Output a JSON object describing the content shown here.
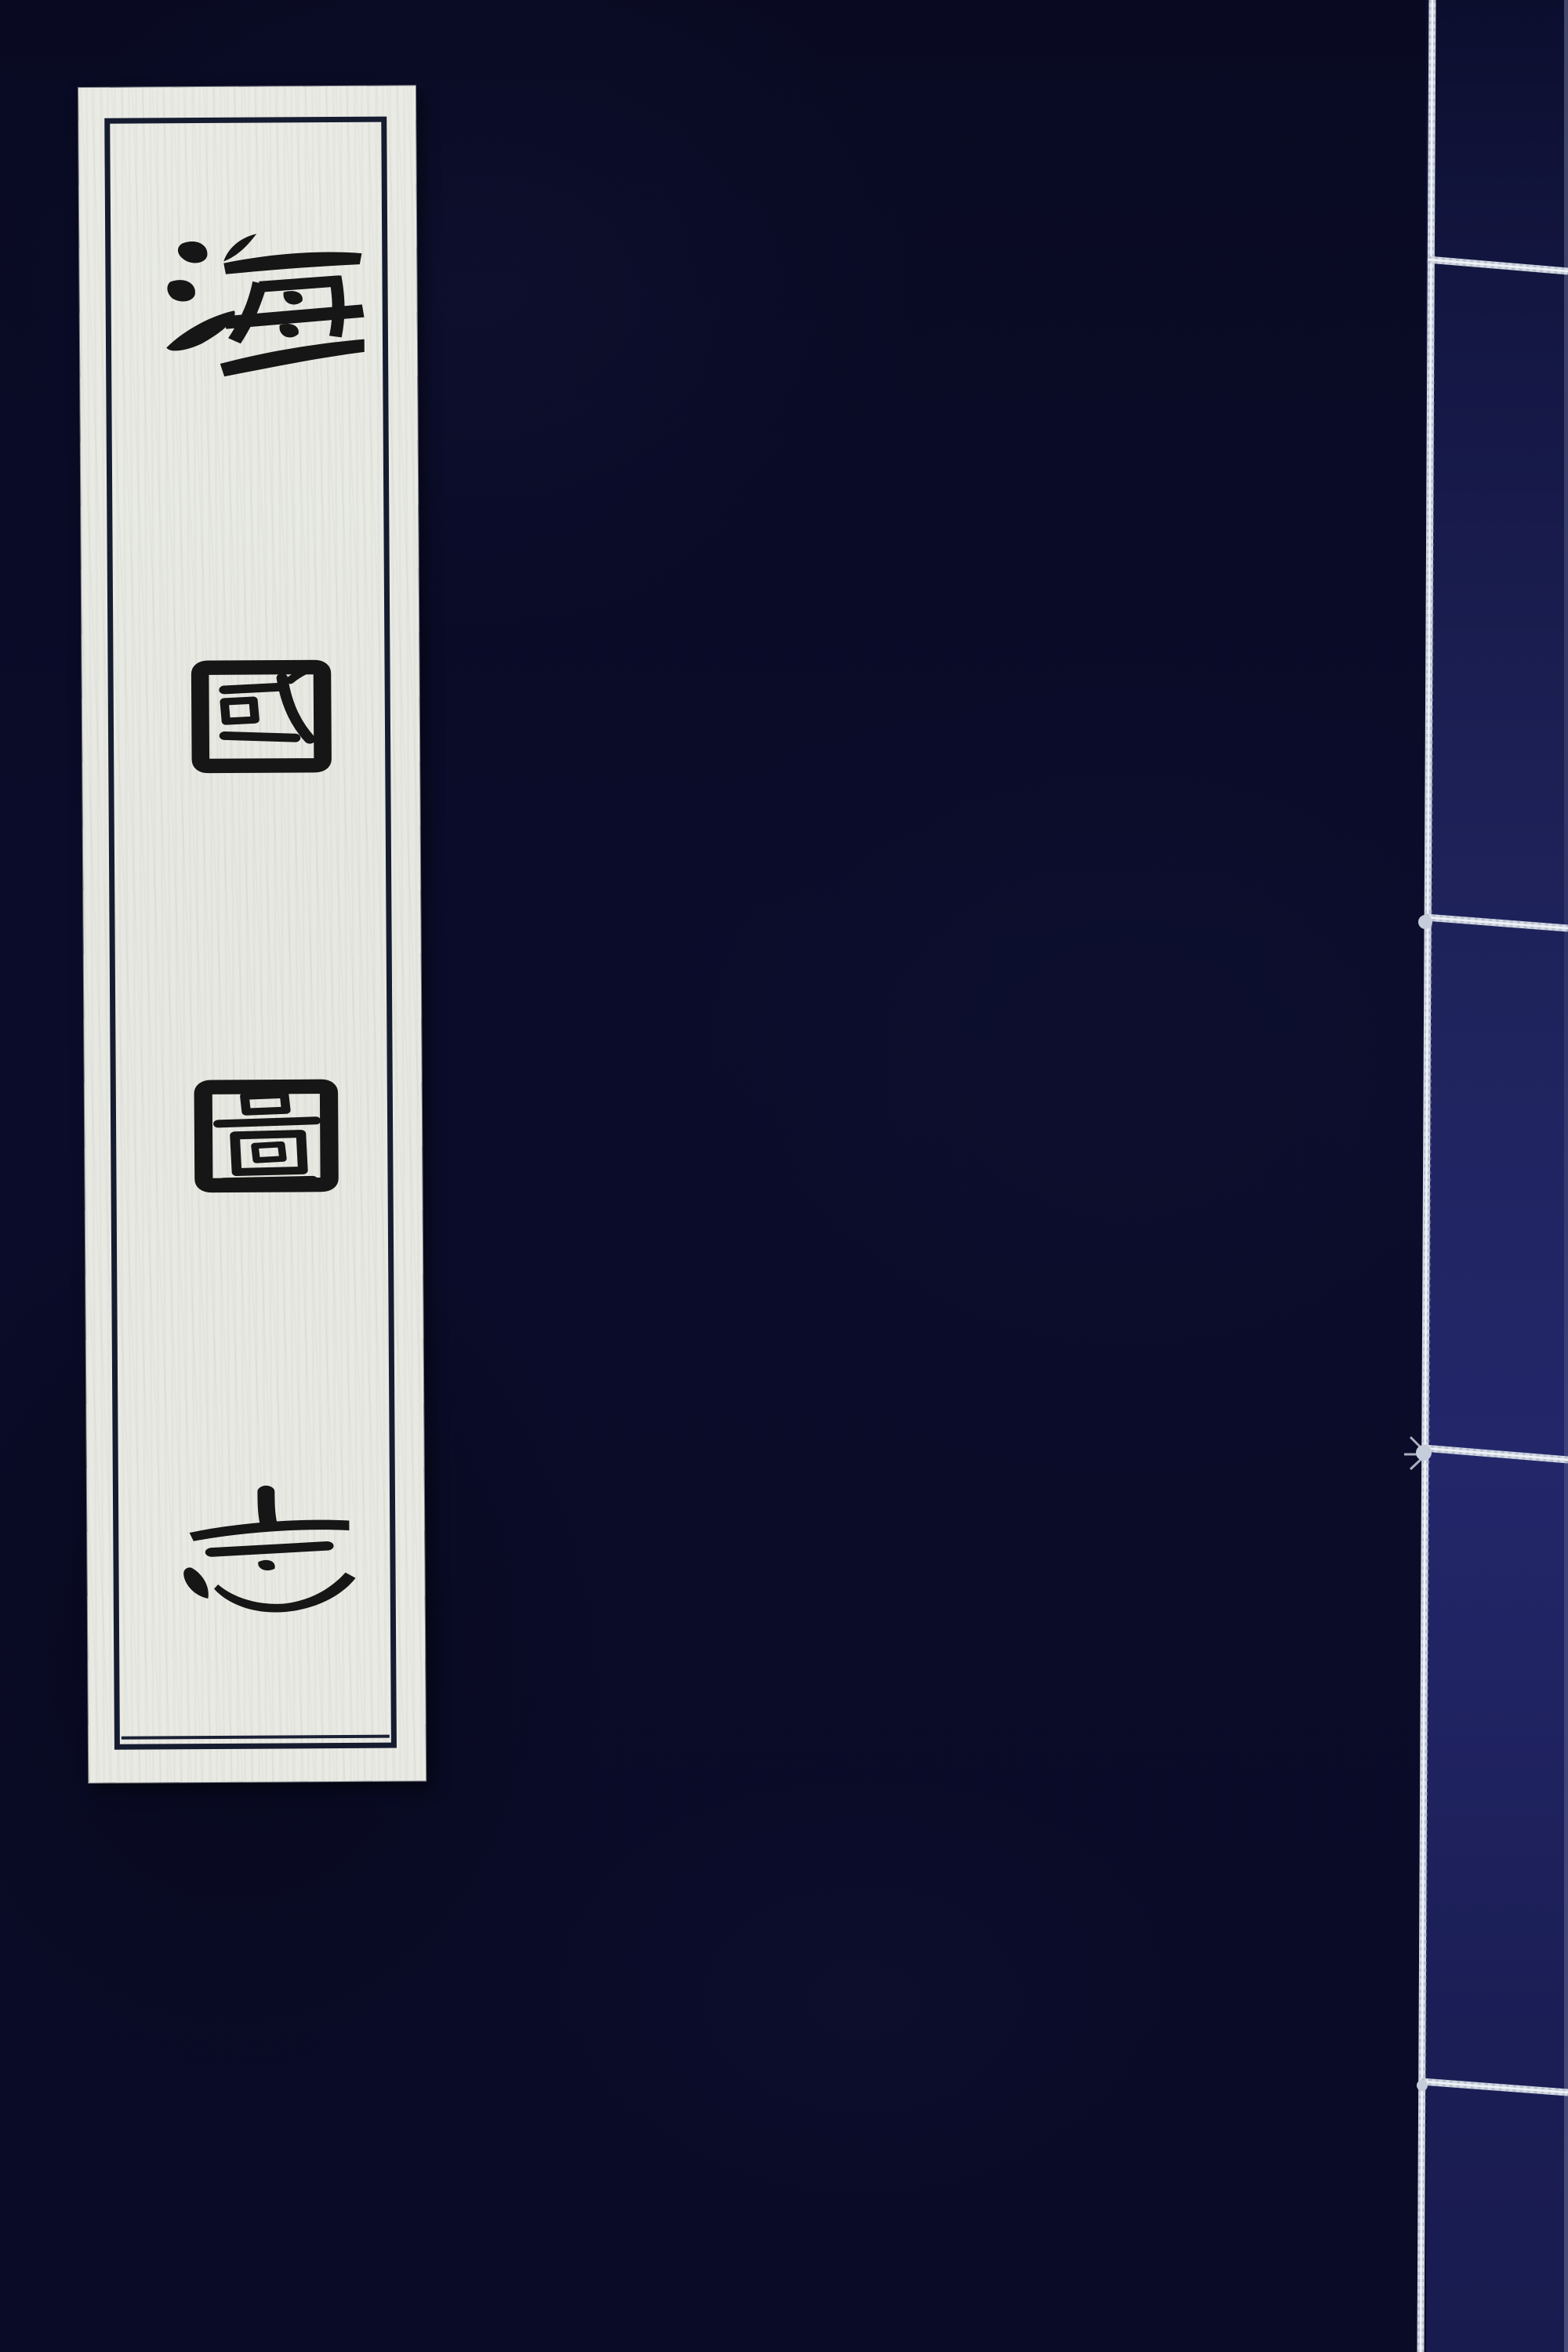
{
  "page": {
    "kind": "book-cover-photo"
  },
  "title": {
    "text": "海國圖志",
    "characters": [
      "海",
      "國",
      "圖",
      "志"
    ],
    "orientation": "vertical-top-to-bottom",
    "script_style": "clerical-script"
  },
  "binding": {
    "style": "thread-stitched",
    "stitch_count": 4,
    "thread_color": "#cfd6e2"
  },
  "colors": {
    "cover_cloth": "#0a0b26",
    "binding_panel": "#23276a",
    "label_paper": "#e9eae3",
    "label_frame": "#161c30",
    "ink": "#161616"
  }
}
